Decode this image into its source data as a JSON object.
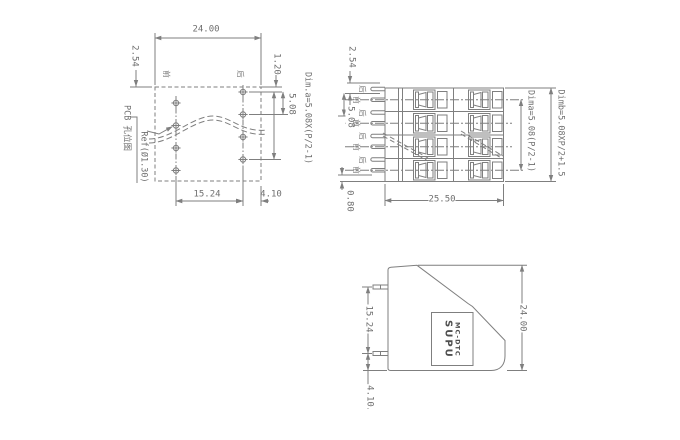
{
  "drawing": {
    "background": "#ffffff",
    "line_color": "#7f7f7f",
    "text_color": "#6f6f6f",
    "views": {
      "pcb_layout": {
        "title_vertical": "PCB 孔位图",
        "ref_label": "Ref(Ø1.30)",
        "front_label": "前",
        "rear_label": "后",
        "dims": {
          "width": "24.00",
          "row_offset": "2.54",
          "edge_to_first_hole": "1.20",
          "pitch": "5.08",
          "dim_a": "Dim.a=5.08X(P/2-1)",
          "hole_span": "15.24",
          "edge_margin": "4.10"
        }
      },
      "top_view": {
        "pin_labels": [
          "后",
          "前",
          "后",
          "前",
          "后",
          "前",
          "后",
          "前"
        ],
        "dims": {
          "pin_offset": "2.54",
          "pitch": "5.08",
          "pin_edge": "0.80",
          "body_width": "25.50",
          "dim_a": "Dima=5.08(P/2-1)",
          "dim_b": "Dimb=5.08XP/2+1.5"
        }
      },
      "side_view": {
        "logo_line1": "SUPU",
        "logo_line2": "MC-DTC",
        "dims": {
          "pin_span": "15.24",
          "body_height": "24.00",
          "pin_to_bottom": "4.10"
        }
      }
    }
  }
}
